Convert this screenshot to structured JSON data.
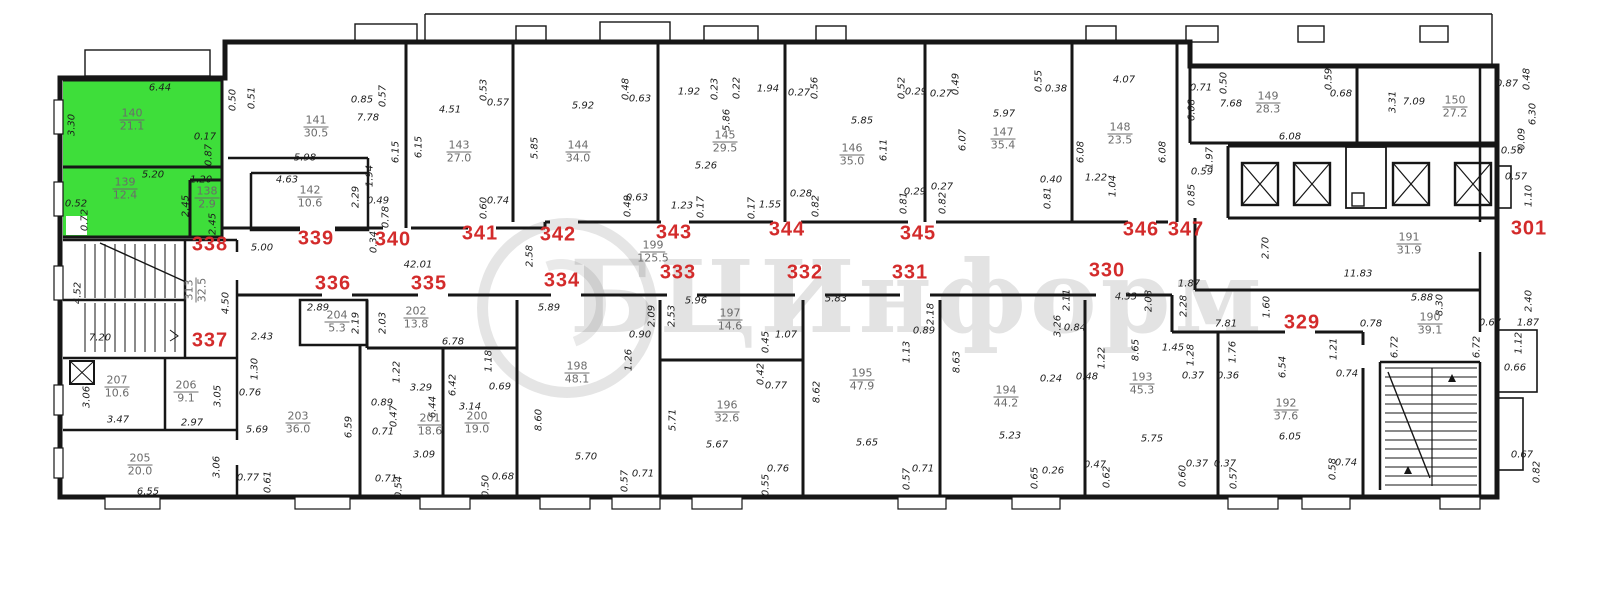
{
  "watermark": {
    "text": "БЦИнформ"
  },
  "colors": {
    "highlight": "#3ede3a",
    "unit_number": "#d32b2b",
    "walls": "#161616",
    "dims": "#1c1c1c"
  },
  "units": [
    {
      "n": "338",
      "x": 210,
      "y": 245
    },
    {
      "n": "339",
      "x": 316,
      "y": 239
    },
    {
      "n": "340",
      "x": 393,
      "y": 240
    },
    {
      "n": "341",
      "x": 480,
      "y": 234
    },
    {
      "n": "342",
      "x": 558,
      "y": 235
    },
    {
      "n": "343",
      "x": 674,
      "y": 233
    },
    {
      "n": "344",
      "x": 787,
      "y": 230
    },
    {
      "n": "345",
      "x": 918,
      "y": 234
    },
    {
      "n": "346",
      "x": 1141,
      "y": 230
    },
    {
      "n": "347",
      "x": 1186,
      "y": 230
    },
    {
      "n": "301",
      "x": 1529,
      "y": 229
    },
    {
      "n": "337",
      "x": 210,
      "y": 341
    },
    {
      "n": "336",
      "x": 333,
      "y": 284
    },
    {
      "n": "335",
      "x": 429,
      "y": 284
    },
    {
      "n": "334",
      "x": 562,
      "y": 281
    },
    {
      "n": "333",
      "x": 678,
      "y": 273
    },
    {
      "n": "332",
      "x": 805,
      "y": 273
    },
    {
      "n": "331",
      "x": 910,
      "y": 273
    },
    {
      "n": "330",
      "x": 1107,
      "y": 271
    },
    {
      "n": "329",
      "x": 1302,
      "y": 323
    }
  ],
  "rooms": [
    {
      "id": "140",
      "area": "21.1",
      "x": 132,
      "y": 120
    },
    {
      "id": "139",
      "area": "12.4",
      "x": 125,
      "y": 189
    },
    {
      "id": "138",
      "area": "2.9",
      "x": 207,
      "y": 198
    },
    {
      "id": "141",
      "area": "30.5",
      "x": 316,
      "y": 127
    },
    {
      "id": "142",
      "area": "10.6",
      "x": 310,
      "y": 197
    },
    {
      "id": "143",
      "area": "27.0",
      "x": 459,
      "y": 152
    },
    {
      "id": "144",
      "area": "34.0",
      "x": 578,
      "y": 152
    },
    {
      "id": "145",
      "area": "29.5",
      "x": 725,
      "y": 142
    },
    {
      "id": "146",
      "area": "35.0",
      "x": 852,
      "y": 155
    },
    {
      "id": "147",
      "area": "35.4",
      "x": 1003,
      "y": 139
    },
    {
      "id": "148",
      "area": "23.5",
      "x": 1120,
      "y": 134
    },
    {
      "id": "149",
      "area": "28.3",
      "x": 1268,
      "y": 103
    },
    {
      "id": "150",
      "area": "27.2",
      "x": 1455,
      "y": 107
    },
    {
      "id": "191",
      "area": "31.9",
      "x": 1409,
      "y": 244
    },
    {
      "id": "190",
      "area": "39.1",
      "x": 1430,
      "y": 324
    },
    {
      "id": "199",
      "area": "125.5",
      "x": 653,
      "y": 252
    },
    {
      "id": "313",
      "area": "32.5",
      "x": 196,
      "y": 290,
      "r": 1
    },
    {
      "id": "207",
      "area": "10.6",
      "x": 117,
      "y": 387
    },
    {
      "id": "206",
      "area": "9.1",
      "x": 186,
      "y": 392
    },
    {
      "id": "205",
      "area": "20.0",
      "x": 140,
      "y": 465
    },
    {
      "id": "203",
      "area": "36.0",
      "x": 298,
      "y": 423
    },
    {
      "id": "204",
      "area": "5.3",
      "x": 337,
      "y": 322
    },
    {
      "id": "202",
      "area": "13.8",
      "x": 416,
      "y": 318
    },
    {
      "id": "201",
      "area": "18.6",
      "x": 430,
      "y": 425
    },
    {
      "id": "200",
      "area": "19.0",
      "x": 477,
      "y": 423
    },
    {
      "id": "198",
      "area": "48.1",
      "x": 577,
      "y": 373
    },
    {
      "id": "197",
      "area": "14.6",
      "x": 730,
      "y": 320
    },
    {
      "id": "196",
      "area": "32.6",
      "x": 727,
      "y": 412
    },
    {
      "id": "195",
      "area": "47.9",
      "x": 862,
      "y": 380
    },
    {
      "id": "194",
      "area": "44.2",
      "x": 1006,
      "y": 397
    },
    {
      "id": "193",
      "area": "45.3",
      "x": 1142,
      "y": 384
    },
    {
      "id": "192",
      "area": "37.6",
      "x": 1286,
      "y": 410
    }
  ],
  "dims": [
    {
      "t": "6.44",
      "x": 160,
      "y": 88
    },
    {
      "t": "3.30",
      "x": 72,
      "y": 125,
      "r": 1
    },
    {
      "t": "0.17",
      "x": 205,
      "y": 137
    },
    {
      "t": "0.87",
      "x": 209,
      "y": 155,
      "r": 1
    },
    {
      "t": "5.20",
      "x": 153,
      "y": 175
    },
    {
      "t": "1.20",
      "x": 201,
      "y": 180
    },
    {
      "t": "2.45",
      "x": 186,
      "y": 206,
      "r": 1
    },
    {
      "t": "2.45",
      "x": 213,
      "y": 224,
      "r": 1
    },
    {
      "t": "0.52",
      "x": 76,
      "y": 204
    },
    {
      "t": "0.72",
      "x": 85,
      "y": 220,
      "r": 1
    },
    {
      "t": "0.50",
      "x": 233,
      "y": 100,
      "r": 1
    },
    {
      "t": "0.51",
      "x": 252,
      "y": 98,
      "r": 1
    },
    {
      "t": "0.85",
      "x": 362,
      "y": 100
    },
    {
      "t": "0.57",
      "x": 383,
      "y": 96,
      "r": 1
    },
    {
      "t": "7.78",
      "x": 368,
      "y": 118
    },
    {
      "t": "5.98",
      "x": 305,
      "y": 158
    },
    {
      "t": "1.94",
      "x": 370,
      "y": 176,
      "r": 1
    },
    {
      "t": "6.15",
      "x": 396,
      "y": 152,
      "r": 1
    },
    {
      "t": "6.15",
      "x": 419,
      "y": 147,
      "r": 1
    },
    {
      "t": "4.63",
      "x": 287,
      "y": 180
    },
    {
      "t": "2.29",
      "x": 356,
      "y": 197,
      "r": 1
    },
    {
      "t": "0.49",
      "x": 378,
      "y": 201
    },
    {
      "t": "0.78",
      "x": 386,
      "y": 217,
      "r": 1
    },
    {
      "t": "0.34",
      "x": 374,
      "y": 242,
      "r": 1
    },
    {
      "t": "4.51",
      "x": 450,
      "y": 110
    },
    {
      "t": "0.53",
      "x": 484,
      "y": 90,
      "r": 1
    },
    {
      "t": "0.57",
      "x": 498,
      "y": 103
    },
    {
      "t": "0.74",
      "x": 498,
      "y": 201
    },
    {
      "t": "0.60",
      "x": 484,
      "y": 208,
      "r": 1
    },
    {
      "t": "5.92",
      "x": 583,
      "y": 106
    },
    {
      "t": "0.48",
      "x": 626,
      "y": 89,
      "r": 1
    },
    {
      "t": "0.63",
      "x": 640,
      "y": 99
    },
    {
      "t": "5.85",
      "x": 535,
      "y": 148,
      "r": 1
    },
    {
      "t": "0.63",
      "x": 637,
      "y": 198
    },
    {
      "t": "0.49",
      "x": 628,
      "y": 206,
      "r": 1
    },
    {
      "t": "1.92",
      "x": 689,
      "y": 92
    },
    {
      "t": "0.23",
      "x": 715,
      "y": 89,
      "r": 1
    },
    {
      "t": "0.22",
      "x": 737,
      "y": 88,
      "r": 1
    },
    {
      "t": "1.94",
      "x": 768,
      "y": 89
    },
    {
      "t": "5.86",
      "x": 727,
      "y": 120,
      "r": 1
    },
    {
      "t": "5.26",
      "x": 706,
      "y": 166
    },
    {
      "t": "1.23",
      "x": 682,
      "y": 206
    },
    {
      "t": "0.17",
      "x": 701,
      "y": 207,
      "r": 1
    },
    {
      "t": "0.17",
      "x": 752,
      "y": 208,
      "r": 1
    },
    {
      "t": "1.55",
      "x": 770,
      "y": 205
    },
    {
      "t": "0.28",
      "x": 801,
      "y": 194
    },
    {
      "t": "0.82",
      "x": 816,
      "y": 206,
      "r": 1
    },
    {
      "t": "0.27",
      "x": 799,
      "y": 93
    },
    {
      "t": "0.56",
      "x": 815,
      "y": 88,
      "r": 1
    },
    {
      "t": "5.85",
      "x": 862,
      "y": 121
    },
    {
      "t": "6.11",
      "x": 884,
      "y": 150,
      "r": 1
    },
    {
      "t": "0.52",
      "x": 902,
      "y": 88,
      "r": 1
    },
    {
      "t": "0.29",
      "x": 916,
      "y": 92
    },
    {
      "t": "0.27",
      "x": 941,
      "y": 94
    },
    {
      "t": "0.29",
      "x": 915,
      "y": 192
    },
    {
      "t": "0.81",
      "x": 904,
      "y": 203,
      "r": 1
    },
    {
      "t": "0.27",
      "x": 942,
      "y": 187
    },
    {
      "t": "0.82",
      "x": 943,
      "y": 203,
      "r": 1
    },
    {
      "t": "0.49",
      "x": 956,
      "y": 84,
      "r": 1
    },
    {
      "t": "5.97",
      "x": 1004,
      "y": 114
    },
    {
      "t": "6.07",
      "x": 963,
      "y": 140,
      "r": 1
    },
    {
      "t": "0.55",
      "x": 1039,
      "y": 81,
      "r": 1
    },
    {
      "t": "0.38",
      "x": 1056,
      "y": 89
    },
    {
      "t": "0.40",
      "x": 1051,
      "y": 180
    },
    {
      "t": "0.81",
      "x": 1048,
      "y": 198,
      "r": 1
    },
    {
      "t": "4.07",
      "x": 1124,
      "y": 80
    },
    {
      "t": "6.08",
      "x": 1081,
      "y": 152,
      "r": 1
    },
    {
      "t": "6.08",
      "x": 1163,
      "y": 152,
      "r": 1
    },
    {
      "t": "1.22",
      "x": 1096,
      "y": 178
    },
    {
      "t": "1.04",
      "x": 1113,
      "y": 186,
      "r": 1
    },
    {
      "t": "1.97",
      "x": 1210,
      "y": 158,
      "r": 1
    },
    {
      "t": "0.59",
      "x": 1202,
      "y": 172
    },
    {
      "t": "0.85",
      "x": 1192,
      "y": 195,
      "r": 1
    },
    {
      "t": "0.71",
      "x": 1201,
      "y": 88
    },
    {
      "t": "0.50",
      "x": 1224,
      "y": 83,
      "r": 1
    },
    {
      "t": "7.68",
      "x": 1231,
      "y": 104
    },
    {
      "t": "0.59",
      "x": 1329,
      "y": 79,
      "r": 1
    },
    {
      "t": "0.68",
      "x": 1341,
      "y": 94
    },
    {
      "t": "6.08",
      "x": 1290,
      "y": 137
    },
    {
      "t": "6.08",
      "x": 1192,
      "y": 110,
      "r": 1
    },
    {
      "t": "3.31",
      "x": 1393,
      "y": 102,
      "r": 1
    },
    {
      "t": "7.09",
      "x": 1414,
      "y": 102
    },
    {
      "t": "0.87",
      "x": 1507,
      "y": 84
    },
    {
      "t": "0.48",
      "x": 1527,
      "y": 79,
      "r": 1
    },
    {
      "t": "6.30",
      "x": 1533,
      "y": 114,
      "r": 1
    },
    {
      "t": "0.09",
      "x": 1522,
      "y": 139,
      "r": 1
    },
    {
      "t": "0.56",
      "x": 1512,
      "y": 151
    },
    {
      "t": "0.57",
      "x": 1516,
      "y": 177
    },
    {
      "t": "1.10",
      "x": 1529,
      "y": 196,
      "r": 1
    },
    {
      "t": "2.70",
      "x": 1266,
      "y": 248,
      "r": 1
    },
    {
      "t": "11.83",
      "x": 1358,
      "y": 274
    },
    {
      "t": "2.40",
      "x": 1529,
      "y": 301,
      "r": 1
    },
    {
      "t": "0.67",
      "x": 1490,
      "y": 323
    },
    {
      "t": "1.87",
      "x": 1528,
      "y": 323
    },
    {
      "t": "1.12",
      "x": 1519,
      "y": 343,
      "r": 1
    },
    {
      "t": "0.66",
      "x": 1515,
      "y": 368
    },
    {
      "t": "0.67",
      "x": 1522,
      "y": 455
    },
    {
      "t": "0.82",
      "x": 1537,
      "y": 472,
      "r": 1
    },
    {
      "t": "5.88",
      "x": 1422,
      "y": 298
    },
    {
      "t": "8.30",
      "x": 1440,
      "y": 305,
      "r": 1
    },
    {
      "t": "6.72",
      "x": 1395,
      "y": 347,
      "r": 1
    },
    {
      "t": "6.72",
      "x": 1477,
      "y": 347,
      "r": 1
    },
    {
      "t": "0.78",
      "x": 1371,
      "y": 324
    },
    {
      "t": "0.74",
      "x": 1347,
      "y": 374
    },
    {
      "t": "1.21",
      "x": 1334,
      "y": 349,
      "r": 1
    },
    {
      "t": "0.74",
      "x": 1346,
      "y": 463
    },
    {
      "t": "0.58",
      "x": 1333,
      "y": 469,
      "r": 1
    },
    {
      "t": "5.00",
      "x": 262,
      "y": 248
    },
    {
      "t": "42.01",
      "x": 418,
      "y": 265
    },
    {
      "t": "2.58",
      "x": 530,
      "y": 256,
      "r": 1
    },
    {
      "t": "1.87",
      "x": 1189,
      "y": 284
    },
    {
      "t": "2.28",
      "x": 1184,
      "y": 306,
      "r": 1
    },
    {
      "t": "7.81",
      "x": 1226,
      "y": 324
    },
    {
      "t": "1.60",
      "x": 1267,
      "y": 307,
      "r": 1
    },
    {
      "t": "4.33",
      "x": 1126,
      "y": 297
    },
    {
      "t": "2.08",
      "x": 1149,
      "y": 301,
      "r": 1
    },
    {
      "t": "4.52",
      "x": 78,
      "y": 293,
      "r": 1
    },
    {
      "t": "7.20",
      "x": 100,
      "y": 338
    },
    {
      "t": "4.50",
      "x": 226,
      "y": 303,
      "r": 1
    },
    {
      "t": "2.43",
      "x": 262,
      "y": 337
    },
    {
      "t": "3.06",
      "x": 87,
      "y": 397,
      "r": 1
    },
    {
      "t": "3.47",
      "x": 118,
      "y": 420
    },
    {
      "t": "3.05",
      "x": 218,
      "y": 396,
      "r": 1
    },
    {
      "t": "2.97",
      "x": 192,
      "y": 423
    },
    {
      "t": "3.06",
      "x": 217,
      "y": 467,
      "r": 1
    },
    {
      "t": "6.55",
      "x": 148,
      "y": 492
    },
    {
      "t": "0.77",
      "x": 248,
      "y": 478
    },
    {
      "t": "0.61",
      "x": 268,
      "y": 482,
      "r": 1
    },
    {
      "t": "1.30",
      "x": 255,
      "y": 369,
      "r": 1
    },
    {
      "t": "0.76",
      "x": 250,
      "y": 393
    },
    {
      "t": "5.69",
      "x": 257,
      "y": 430
    },
    {
      "t": "2.89",
      "x": 318,
      "y": 308
    },
    {
      "t": "2.19",
      "x": 356,
      "y": 323,
      "r": 1
    },
    {
      "t": "2.03",
      "x": 383,
      "y": 323,
      "r": 1
    },
    {
      "t": "6.78",
      "x": 453,
      "y": 342
    },
    {
      "t": "6.59",
      "x": 349,
      "y": 427,
      "r": 1
    },
    {
      "t": "1.22",
      "x": 397,
      "y": 372,
      "r": 1
    },
    {
      "t": "3.29",
      "x": 421,
      "y": 388
    },
    {
      "t": "0.89",
      "x": 382,
      "y": 403
    },
    {
      "t": "0.47",
      "x": 394,
      "y": 416,
      "r": 1
    },
    {
      "t": "0.71",
      "x": 383,
      "y": 432
    },
    {
      "t": "6.44",
      "x": 433,
      "y": 407,
      "r": 1
    },
    {
      "t": "3.09",
      "x": 424,
      "y": 455
    },
    {
      "t": "0.71",
      "x": 386,
      "y": 479
    },
    {
      "t": "0.54",
      "x": 399,
      "y": 487,
      "r": 1
    },
    {
      "t": "6.42",
      "x": 453,
      "y": 385,
      "r": 1
    },
    {
      "t": "3.14",
      "x": 470,
      "y": 407
    },
    {
      "t": "1.18",
      "x": 489,
      "y": 361,
      "r": 1
    },
    {
      "t": "0.69",
      "x": 500,
      "y": 387
    },
    {
      "t": "0.50",
      "x": 486,
      "y": 486,
      "r": 1
    },
    {
      "t": "0.68",
      "x": 503,
      "y": 477
    },
    {
      "t": "5.89",
      "x": 549,
      "y": 308
    },
    {
      "t": "8.60",
      "x": 539,
      "y": 420,
      "r": 1
    },
    {
      "t": "5.70",
      "x": 586,
      "y": 457
    },
    {
      "t": "0.90",
      "x": 640,
      "y": 335
    },
    {
      "t": "1.26",
      "x": 629,
      "y": 360,
      "r": 1
    },
    {
      "t": "2.09",
      "x": 652,
      "y": 316,
      "r": 1
    },
    {
      "t": "0.57",
      "x": 625,
      "y": 481,
      "r": 1
    },
    {
      "t": "0.71",
      "x": 643,
      "y": 474
    },
    {
      "t": "5.96",
      "x": 696,
      "y": 301
    },
    {
      "t": "2.53",
      "x": 672,
      "y": 316,
      "r": 1
    },
    {
      "t": "0.45",
      "x": 766,
      "y": 342,
      "r": 1
    },
    {
      "t": "1.07",
      "x": 786,
      "y": 335
    },
    {
      "t": "0.42",
      "x": 761,
      "y": 374,
      "r": 1
    },
    {
      "t": "0.77",
      "x": 776,
      "y": 386
    },
    {
      "t": "5.71",
      "x": 673,
      "y": 420,
      "r": 1
    },
    {
      "t": "5.67",
      "x": 717,
      "y": 445
    },
    {
      "t": "0.76",
      "x": 778,
      "y": 469
    },
    {
      "t": "0.55",
      "x": 766,
      "y": 485,
      "r": 1
    },
    {
      "t": "5.83",
      "x": 836,
      "y": 299
    },
    {
      "t": "8.62",
      "x": 817,
      "y": 392,
      "r": 1
    },
    {
      "t": "5.65",
      "x": 867,
      "y": 443
    },
    {
      "t": "2.18",
      "x": 931,
      "y": 314,
      "r": 1
    },
    {
      "t": "0.89",
      "x": 924,
      "y": 331
    },
    {
      "t": "1.13",
      "x": 907,
      "y": 352,
      "r": 1
    },
    {
      "t": "0.71",
      "x": 923,
      "y": 469
    },
    {
      "t": "0.57",
      "x": 907,
      "y": 479,
      "r": 1
    },
    {
      "t": "8.63",
      "x": 957,
      "y": 362,
      "r": 1
    },
    {
      "t": "5.23",
      "x": 1010,
      "y": 436
    },
    {
      "t": "3.26",
      "x": 1058,
      "y": 326,
      "r": 1
    },
    {
      "t": "0.84",
      "x": 1075,
      "y": 328
    },
    {
      "t": "2.11",
      "x": 1067,
      "y": 300,
      "r": 1
    },
    {
      "t": "0.24",
      "x": 1051,
      "y": 379
    },
    {
      "t": "0.48",
      "x": 1087,
      "y": 377
    },
    {
      "t": "0.26",
      "x": 1053,
      "y": 471
    },
    {
      "t": "0.65",
      "x": 1035,
      "y": 478,
      "r": 1
    },
    {
      "t": "0.47",
      "x": 1095,
      "y": 465
    },
    {
      "t": "0.62",
      "x": 1107,
      "y": 477,
      "r": 1
    },
    {
      "t": "8.65",
      "x": 1136,
      "y": 350,
      "r": 1
    },
    {
      "t": "5.75",
      "x": 1152,
      "y": 439
    },
    {
      "t": "1.45",
      "x": 1173,
      "y": 348
    },
    {
      "t": "1.28",
      "x": 1191,
      "y": 355,
      "r": 1
    },
    {
      "t": "0.37",
      "x": 1193,
      "y": 376
    },
    {
      "t": "1.22",
      "x": 1102,
      "y": 358,
      "r": 1
    },
    {
      "t": "0.60",
      "x": 1183,
      "y": 476,
      "r": 1
    },
    {
      "t": "0.37",
      "x": 1197,
      "y": 464
    },
    {
      "t": "1.76",
      "x": 1233,
      "y": 352,
      "r": 1
    },
    {
      "t": "0.36",
      "x": 1228,
      "y": 376
    },
    {
      "t": "6.54",
      "x": 1283,
      "y": 367,
      "r": 1
    },
    {
      "t": "6.05",
      "x": 1290,
      "y": 437
    },
    {
      "t": "0.37",
      "x": 1225,
      "y": 464
    },
    {
      "t": "0.57",
      "x": 1234,
      "y": 478,
      "r": 1
    }
  ]
}
